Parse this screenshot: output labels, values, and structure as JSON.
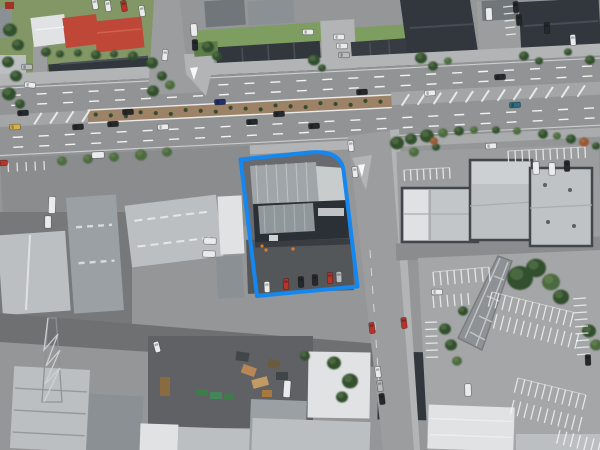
{
  "meta": {
    "view": "aerial-imagery",
    "width": 600,
    "height": 450,
    "description": "Oblique aerial photograph of a commercial/industrial block beside a multi-lane arterial road; one parcel containing a dark-roofed warehouse and its parking yard is outlined with a blue boundary overlay."
  },
  "overlay": {
    "parcel_boundary": {
      "path": "M240.5,159.5 L309,152.5 C327,150.8 341,154.5 343.5,170 L357.5,286.5 L257,296 Z",
      "color": "#1488f0",
      "stroke_width": 4
    }
  },
  "palette": {
    "boundary_blue": "#1488f0",
    "road_asphalt": "#919394",
    "median_soil": "#9c8266",
    "roof_charcoal": "#31373d",
    "roof_red": "#bf4737",
    "roof_white": "#e0e2e3",
    "grass_green": "#7f9661",
    "car_colors": {
      "white": "#e9ebec",
      "silver": "#b9bcbd",
      "dark": "#26292c",
      "red": "#b5352a",
      "navy": "#20306a",
      "teal": "#2c6b80",
      "yellow": "#d2b14a"
    },
    "tree_colors": {
      "d": "#33502f",
      "m": "#4c6b3f",
      "l": "#7a9a58",
      "r": "#9c5636"
    }
  },
  "road": {
    "rotation_deg": -2.9,
    "median": {
      "x0": 88,
      "x1": 392
    },
    "hatch_bands": [
      {
        "x0": 402,
        "x1": 582,
        "step": 16
      },
      {
        "x0": 34,
        "x1": 84,
        "step": 16
      }
    ],
    "median_plants": {
      "x0": 96,
      "x1": 384,
      "step": 15,
      "y": 121,
      "r": 2.1
    }
  },
  "parking_stripe_rows": [
    [
      433,
      272,
      9,
      7,
      14,
      -5,
      1
    ],
    [
      433,
      296,
      6,
      7,
      12,
      -5,
      0
    ],
    [
      492,
      292,
      13,
      7,
      15,
      14,
      1
    ],
    [
      497,
      314,
      13,
      7,
      15,
      14,
      0
    ],
    [
      518,
      378,
      11,
      7,
      15,
      14,
      1
    ],
    [
      514,
      400,
      11,
      7,
      15,
      14,
      0
    ],
    [
      560,
      430,
      8,
      7,
      14,
      14,
      0
    ],
    [
      586,
      298,
      9,
      7,
      13,
      86,
      0
    ],
    [
      437,
      322,
      6,
      7,
      12,
      88,
      0
    ],
    [
      404,
      170,
      8,
      6.5,
      11,
      -3,
      1
    ],
    [
      508,
      151,
      12,
      7,
      11,
      -3,
      1
    ],
    [
      513,
      6,
      5,
      7,
      10,
      84,
      0
    ],
    [
      8,
      163,
      5,
      9,
      9,
      -3,
      0
    ]
  ],
  "cars": [
    [
      15,
      127,
      -3,
      "yellow",
      "c"
    ],
    [
      23,
      113,
      -3,
      "dark",
      "c"
    ],
    [
      2,
      163,
      -3,
      "red",
      "c"
    ],
    [
      78,
      127,
      -3,
      "dark",
      "c"
    ],
    [
      98,
      155,
      -3,
      "white",
      "v"
    ],
    [
      113,
      124,
      -3,
      "dark",
      "c"
    ],
    [
      128,
      112,
      -3,
      "dark",
      "c"
    ],
    [
      163,
      127,
      -3,
      "white",
      "c"
    ],
    [
      220,
      102,
      -3,
      "navy",
      "c"
    ],
    [
      252,
      122,
      -3,
      "dark",
      "c"
    ],
    [
      279,
      114,
      -3,
      "dark",
      "c"
    ],
    [
      314,
      126,
      -3,
      "dark",
      "c"
    ],
    [
      362,
      92,
      -3,
      "dark",
      "c"
    ],
    [
      430,
      93,
      -3,
      "white",
      "c"
    ],
    [
      500,
      77,
      -3,
      "dark",
      "c"
    ],
    [
      515,
      105,
      -3,
      "teal",
      "c"
    ],
    [
      165,
      55,
      95,
      "white",
      "c"
    ],
    [
      194,
      30,
      85,
      "white",
      "v"
    ],
    [
      195,
      45,
      88,
      "dark",
      "c"
    ],
    [
      95,
      4,
      80,
      "white",
      "c"
    ],
    [
      108,
      6,
      82,
      "white",
      "c"
    ],
    [
      124,
      6,
      80,
      "red",
      "c"
    ],
    [
      142,
      11,
      80,
      "white",
      "c"
    ],
    [
      27,
      67,
      0,
      "silver",
      "c"
    ],
    [
      30,
      85,
      5,
      "white",
      "c"
    ],
    [
      308,
      32,
      0,
      "white",
      "c"
    ],
    [
      339,
      37,
      0,
      "white",
      "c"
    ],
    [
      342,
      46,
      0,
      "white",
      "c"
    ],
    [
      344,
      55,
      0,
      "silver",
      "c"
    ],
    [
      489,
      14,
      87,
      "white",
      "v"
    ],
    [
      516,
      7,
      86,
      "dark",
      "c"
    ],
    [
      519,
      20,
      86,
      "dark",
      "c"
    ],
    [
      573,
      40,
      86,
      "white",
      "c"
    ],
    [
      547,
      28,
      86,
      "dark",
      "c"
    ],
    [
      536,
      168,
      88,
      "white",
      "v"
    ],
    [
      552,
      169,
      88,
      "white",
      "v"
    ],
    [
      567,
      166,
      88,
      "dark",
      "c"
    ],
    [
      491,
      146,
      -3,
      "white",
      "c"
    ],
    [
      351,
      146,
      85,
      "white",
      "c"
    ],
    [
      355,
      172,
      85,
      "white",
      "c"
    ],
    [
      372,
      328,
      83,
      "red",
      "c"
    ],
    [
      404,
      323,
      83,
      "red",
      "c"
    ],
    [
      378,
      372,
      83,
      "white",
      "c"
    ],
    [
      380,
      386,
      83,
      "silver",
      "c"
    ],
    [
      382,
      399,
      83,
      "dark",
      "c"
    ],
    [
      588,
      360,
      88,
      "dark",
      "c"
    ],
    [
      437,
      292,
      0,
      "white",
      "c"
    ],
    [
      468,
      390,
      88,
      "white",
      "v"
    ],
    [
      267,
      287,
      88,
      "white",
      "c"
    ],
    [
      286,
      284,
      88,
      "red",
      "c"
    ],
    [
      301,
      282,
      88,
      "dark",
      "c"
    ],
    [
      315,
      280,
      88,
      "dark",
      "c"
    ],
    [
      330,
      278,
      88,
      "red",
      "c"
    ],
    [
      339,
      277,
      88,
      "silver",
      "c"
    ],
    [
      210,
      241,
      2,
      "white",
      "v"
    ],
    [
      209,
      254,
      2,
      "white",
      "v"
    ],
    [
      52,
      205,
      92,
      "white",
      "t"
    ],
    [
      48,
      222,
      90,
      "white",
      "v"
    ],
    [
      157,
      347,
      75,
      "white",
      "c"
    ],
    [
      287,
      389,
      94,
      "white",
      "t"
    ]
  ],
  "trees": [
    [
      10,
      30,
      7,
      "d"
    ],
    [
      18,
      45,
      6,
      "d"
    ],
    [
      8,
      62,
      6,
      "d"
    ],
    [
      16,
      76,
      6,
      "d"
    ],
    [
      9,
      94,
      7,
      "d"
    ],
    [
      20,
      104,
      5,
      "d"
    ],
    [
      46,
      52,
      5,
      "d"
    ],
    [
      60,
      54,
      4,
      "d"
    ],
    [
      78,
      53,
      4,
      "d"
    ],
    [
      96,
      55,
      5,
      "d"
    ],
    [
      114,
      54,
      4,
      "d"
    ],
    [
      133,
      56,
      5,
      "d"
    ],
    [
      152,
      63,
      6,
      "d"
    ],
    [
      162,
      76,
      5,
      "d"
    ],
    [
      153,
      91,
      6,
      "d"
    ],
    [
      170,
      85,
      5,
      "m"
    ],
    [
      208,
      47,
      6,
      "d"
    ],
    [
      217,
      56,
      5,
      "d"
    ],
    [
      314,
      60,
      6,
      "d"
    ],
    [
      322,
      68,
      4,
      "d"
    ],
    [
      421,
      58,
      6,
      "d"
    ],
    [
      433,
      66,
      5,
      "d"
    ],
    [
      448,
      61,
      4,
      "m"
    ],
    [
      524,
      56,
      5,
      "d"
    ],
    [
      539,
      61,
      4,
      "d"
    ],
    [
      568,
      52,
      4,
      "d"
    ],
    [
      590,
      60,
      5,
      "d"
    ],
    [
      62,
      161,
      5,
      "m"
    ],
    [
      88,
      159,
      5,
      "m"
    ],
    [
      114,
      157,
      5,
      "m"
    ],
    [
      141,
      155,
      6,
      "m"
    ],
    [
      167,
      152,
      5,
      "m"
    ],
    [
      397,
      143,
      7,
      "d"
    ],
    [
      411,
      139,
      6,
      "d"
    ],
    [
      427,
      136,
      7,
      "d"
    ],
    [
      443,
      133,
      5,
      "m"
    ],
    [
      459,
      131,
      5,
      "d"
    ],
    [
      414,
      152,
      5,
      "m"
    ],
    [
      436,
      147,
      4,
      "d"
    ],
    [
      434,
      141,
      4,
      "r"
    ],
    [
      474,
      130,
      4,
      "m"
    ],
    [
      496,
      130,
      4,
      "d"
    ],
    [
      517,
      131,
      4,
      "m"
    ],
    [
      543,
      134,
      5,
      "d"
    ],
    [
      557,
      136,
      4,
      "m"
    ],
    [
      571,
      139,
      5,
      "d"
    ],
    [
      584,
      142,
      5,
      "r"
    ],
    [
      596,
      146,
      4,
      "d"
    ],
    [
      520,
      278,
      13,
      "d"
    ],
    [
      536,
      268,
      10,
      "d"
    ],
    [
      551,
      282,
      9,
      "m"
    ],
    [
      561,
      297,
      8,
      "d"
    ],
    [
      589,
      331,
      7,
      "d"
    ],
    [
      596,
      345,
      6,
      "m"
    ],
    [
      445,
      329,
      6,
      "d"
    ],
    [
      451,
      345,
      6,
      "d"
    ],
    [
      457,
      361,
      5,
      "m"
    ],
    [
      463,
      311,
      5,
      "d"
    ],
    [
      334,
      363,
      7,
      "d"
    ],
    [
      350,
      381,
      8,
      "d"
    ],
    [
      342,
      397,
      6,
      "d"
    ],
    [
      305,
      356,
      5,
      "d"
    ]
  ],
  "workers": [
    [
      262,
      246
    ],
    [
      266,
      250
    ],
    [
      293,
      249
    ]
  ]
}
